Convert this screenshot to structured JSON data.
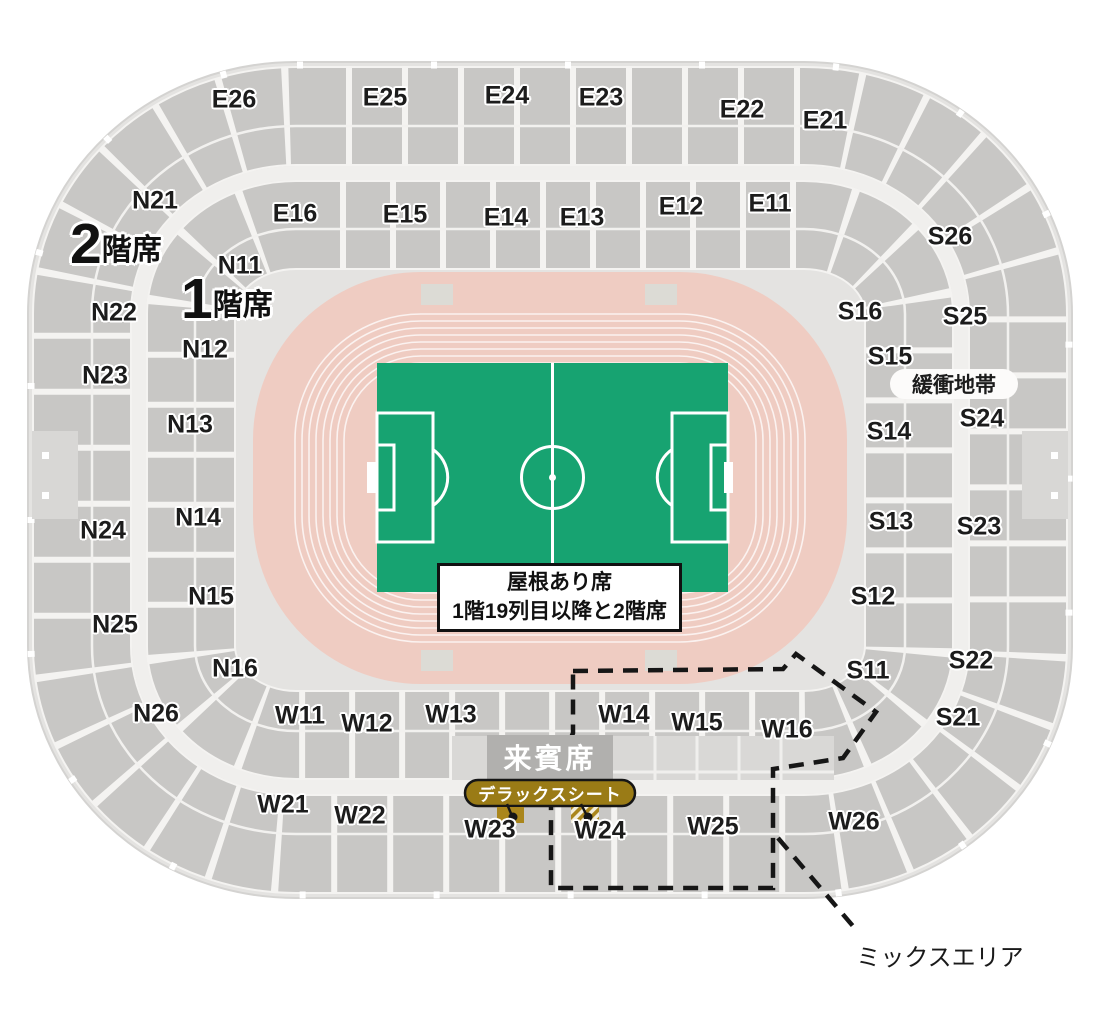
{
  "sections": [
    {
      "id": "E26",
      "x": 234,
      "y": 100
    },
    {
      "id": "E25",
      "x": 385,
      "y": 98
    },
    {
      "id": "E24",
      "x": 507,
      "y": 96
    },
    {
      "id": "E23",
      "x": 601,
      "y": 98
    },
    {
      "id": "E22",
      "x": 742,
      "y": 110
    },
    {
      "id": "E21",
      "x": 825,
      "y": 121
    },
    {
      "id": "E16",
      "x": 295,
      "y": 214
    },
    {
      "id": "E15",
      "x": 405,
      "y": 215
    },
    {
      "id": "E14",
      "x": 506,
      "y": 218
    },
    {
      "id": "E13",
      "x": 582,
      "y": 218
    },
    {
      "id": "E12",
      "x": 681,
      "y": 207
    },
    {
      "id": "E11",
      "x": 770,
      "y": 204
    },
    {
      "id": "N21",
      "x": 155,
      "y": 201
    },
    {
      "id": "N22",
      "x": 114,
      "y": 313
    },
    {
      "id": "N23",
      "x": 105,
      "y": 376
    },
    {
      "id": "N24",
      "x": 103,
      "y": 531
    },
    {
      "id": "N25",
      "x": 115,
      "y": 625
    },
    {
      "id": "N26",
      "x": 156,
      "y": 714
    },
    {
      "id": "N11",
      "x": 240,
      "y": 266
    },
    {
      "id": "N12",
      "x": 205,
      "y": 350
    },
    {
      "id": "N13",
      "x": 190,
      "y": 425
    },
    {
      "id": "N14",
      "x": 198,
      "y": 518
    },
    {
      "id": "N15",
      "x": 211,
      "y": 597
    },
    {
      "id": "N16",
      "x": 235,
      "y": 669
    },
    {
      "id": "S26",
      "x": 950,
      "y": 237
    },
    {
      "id": "S25",
      "x": 965,
      "y": 317
    },
    {
      "id": "S24",
      "x": 982,
      "y": 419
    },
    {
      "id": "S23",
      "x": 979,
      "y": 527
    },
    {
      "id": "S22",
      "x": 971,
      "y": 661
    },
    {
      "id": "S21",
      "x": 958,
      "y": 718
    },
    {
      "id": "S16",
      "x": 860,
      "y": 312
    },
    {
      "id": "S15",
      "x": 890,
      "y": 357
    },
    {
      "id": "S14",
      "x": 889,
      "y": 432
    },
    {
      "id": "S13",
      "x": 891,
      "y": 522
    },
    {
      "id": "S12",
      "x": 873,
      "y": 597
    },
    {
      "id": "S11",
      "x": 868,
      "y": 671
    },
    {
      "id": "W11",
      "x": 300,
      "y": 716
    },
    {
      "id": "W12",
      "x": 367,
      "y": 724
    },
    {
      "id": "W13",
      "x": 451,
      "y": 715
    },
    {
      "id": "W14",
      "x": 624,
      "y": 715
    },
    {
      "id": "W15",
      "x": 697,
      "y": 723
    },
    {
      "id": "W16",
      "x": 787,
      "y": 730
    },
    {
      "id": "W21",
      "x": 283,
      "y": 805
    },
    {
      "id": "W22",
      "x": 360,
      "y": 816
    },
    {
      "id": "W23",
      "x": 490,
      "y": 830
    },
    {
      "id": "W24",
      "x": 600,
      "y": 831
    },
    {
      "id": "W25",
      "x": 713,
      "y": 827
    },
    {
      "id": "W26",
      "x": 854,
      "y": 822
    }
  ],
  "floor_labels": [
    {
      "big": "2",
      "suffix": "階席"
    },
    {
      "big": "1",
      "suffix": "階席"
    }
  ],
  "annotations": {
    "buffer_zone": "緩衝地帯",
    "roof_note_line1": "屋根あり席",
    "roof_note_line2": "1階19列目以降と2階席",
    "vip": "来賓席",
    "deluxe": "デラックスシート",
    "mix_area": "ミックスエリア"
  },
  "colors": {
    "seat_block_gray": "#c8c7c5",
    "stadium_base_gray": "#e4e3e1",
    "track_pink": "#efccc2",
    "field_green": "#17a371",
    "deluxe_gold": "#9a7b16",
    "marker_gold": "#aa861c",
    "vip_box_gray": "#b1b0ae"
  }
}
